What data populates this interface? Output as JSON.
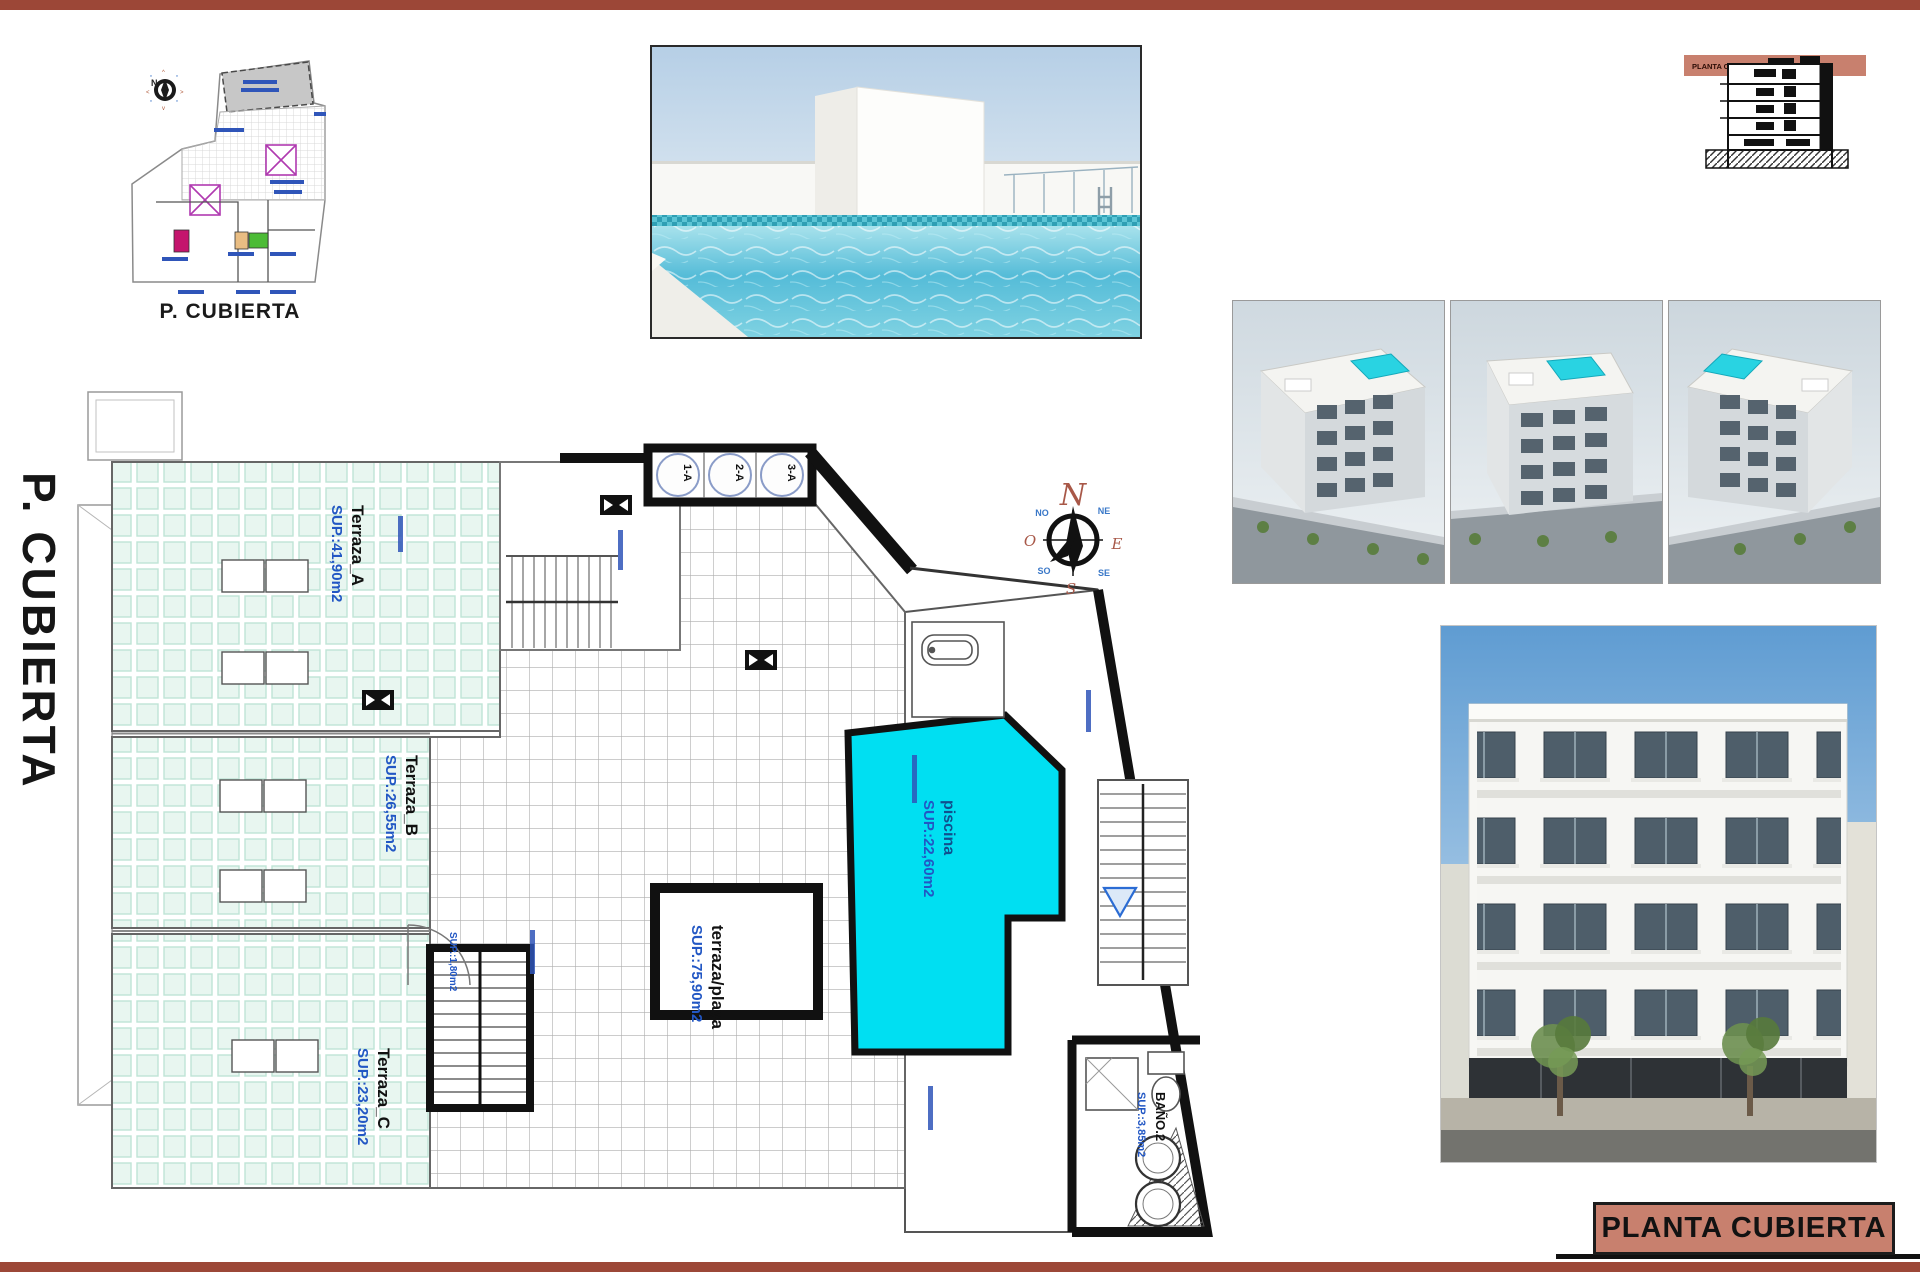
{
  "document": {
    "type": "architectural-sheet",
    "language": "es"
  },
  "left_margin": {
    "title": "P. CUBIERTA"
  },
  "site_plan": {
    "caption": "P. CUBIERTA"
  },
  "section_drawing": {
    "band_label": "PLANTA CUBIERTA"
  },
  "title_block": {
    "label": "PLANTA CUBIERTA"
  },
  "floor_plan": {
    "labels": {
      "terraza_a": {
        "name": "Terraza_A",
        "area": "SUP.:41,90m2"
      },
      "terraza_b": {
        "name": "Terraza_B",
        "area": "SUP.:26,55m2"
      },
      "terraza_c": {
        "name": "Terraza_C",
        "area": "SUP.:23,20m2"
      },
      "terraza_playa": {
        "name": "terraza/playa",
        "area": "SUP.:75,90m2"
      },
      "piscina": {
        "name": "piscina",
        "area": "SUP.:22,60m2"
      },
      "bano_2": {
        "name": "BAÑO.2",
        "area": "SUP.:3,85m2"
      },
      "stair": {
        "area": "SUP.:1,80m2"
      }
    },
    "shafts": [
      "1-A",
      "2-A",
      "3-A"
    ],
    "compass": {
      "n": "N",
      "ne": "NE",
      "e": "E",
      "se": "SE",
      "s": "S",
      "so": "SO",
      "o": "O",
      "no": "NO"
    }
  },
  "colors": {
    "accent_bar": "#9c4737",
    "title_block_fill": "#c8806e",
    "pool_cyan": "#00dff2",
    "terrace_mint": "#e8f6f0",
    "label_blue": "#2257c4",
    "compass_red": "#a85848"
  }
}
